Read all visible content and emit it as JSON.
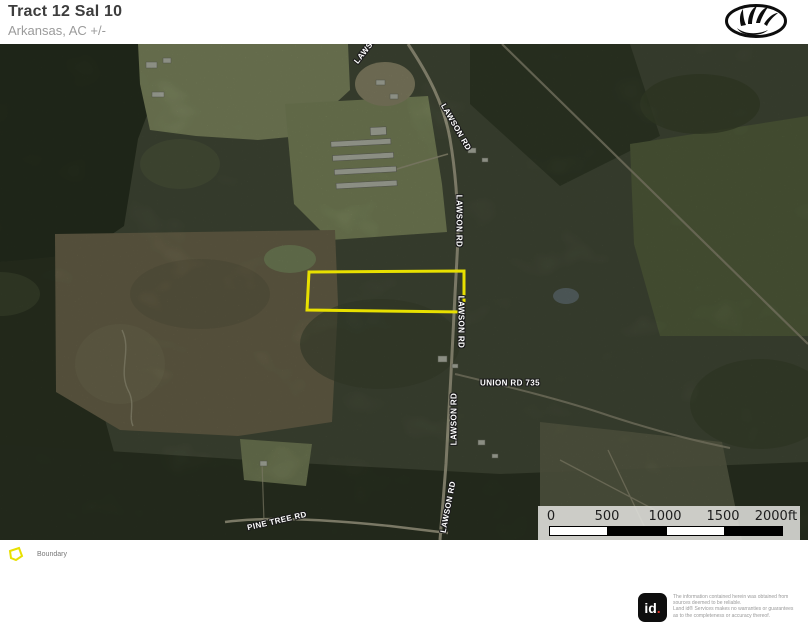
{
  "header": {
    "title": "Tract 12 Sal 10",
    "subtitle": "Arkansas,  AC +/-"
  },
  "map": {
    "boundary_color": "#e8e000",
    "road_labels": [
      {
        "text": "LAWSON RD"
      },
      {
        "text": "LAWSON RD"
      },
      {
        "text": "LAWSON RD"
      },
      {
        "text": "LAWSON RD"
      },
      {
        "text": "LAWSON RD"
      },
      {
        "text": "LAWSON RD"
      },
      {
        "text": "UNION RD 735"
      },
      {
        "text": "PINE TREE RD"
      }
    ]
  },
  "scale_bar": {
    "ticks": [
      "0",
      "500",
      "1000",
      "1500",
      "2000ft"
    ]
  },
  "legend": {
    "items": [
      {
        "label": "Boundary",
        "color": "#e8e000"
      }
    ]
  },
  "footer": {
    "logo_text": "id",
    "logo_dot": ".",
    "disclaimer_lines": [
      "The information contained herein was obtained from",
      "sources deemed to be reliable.",
      " Land id® Services makes no warranties or guarantees",
      "as to the completeness or accuracy thereof."
    ]
  }
}
